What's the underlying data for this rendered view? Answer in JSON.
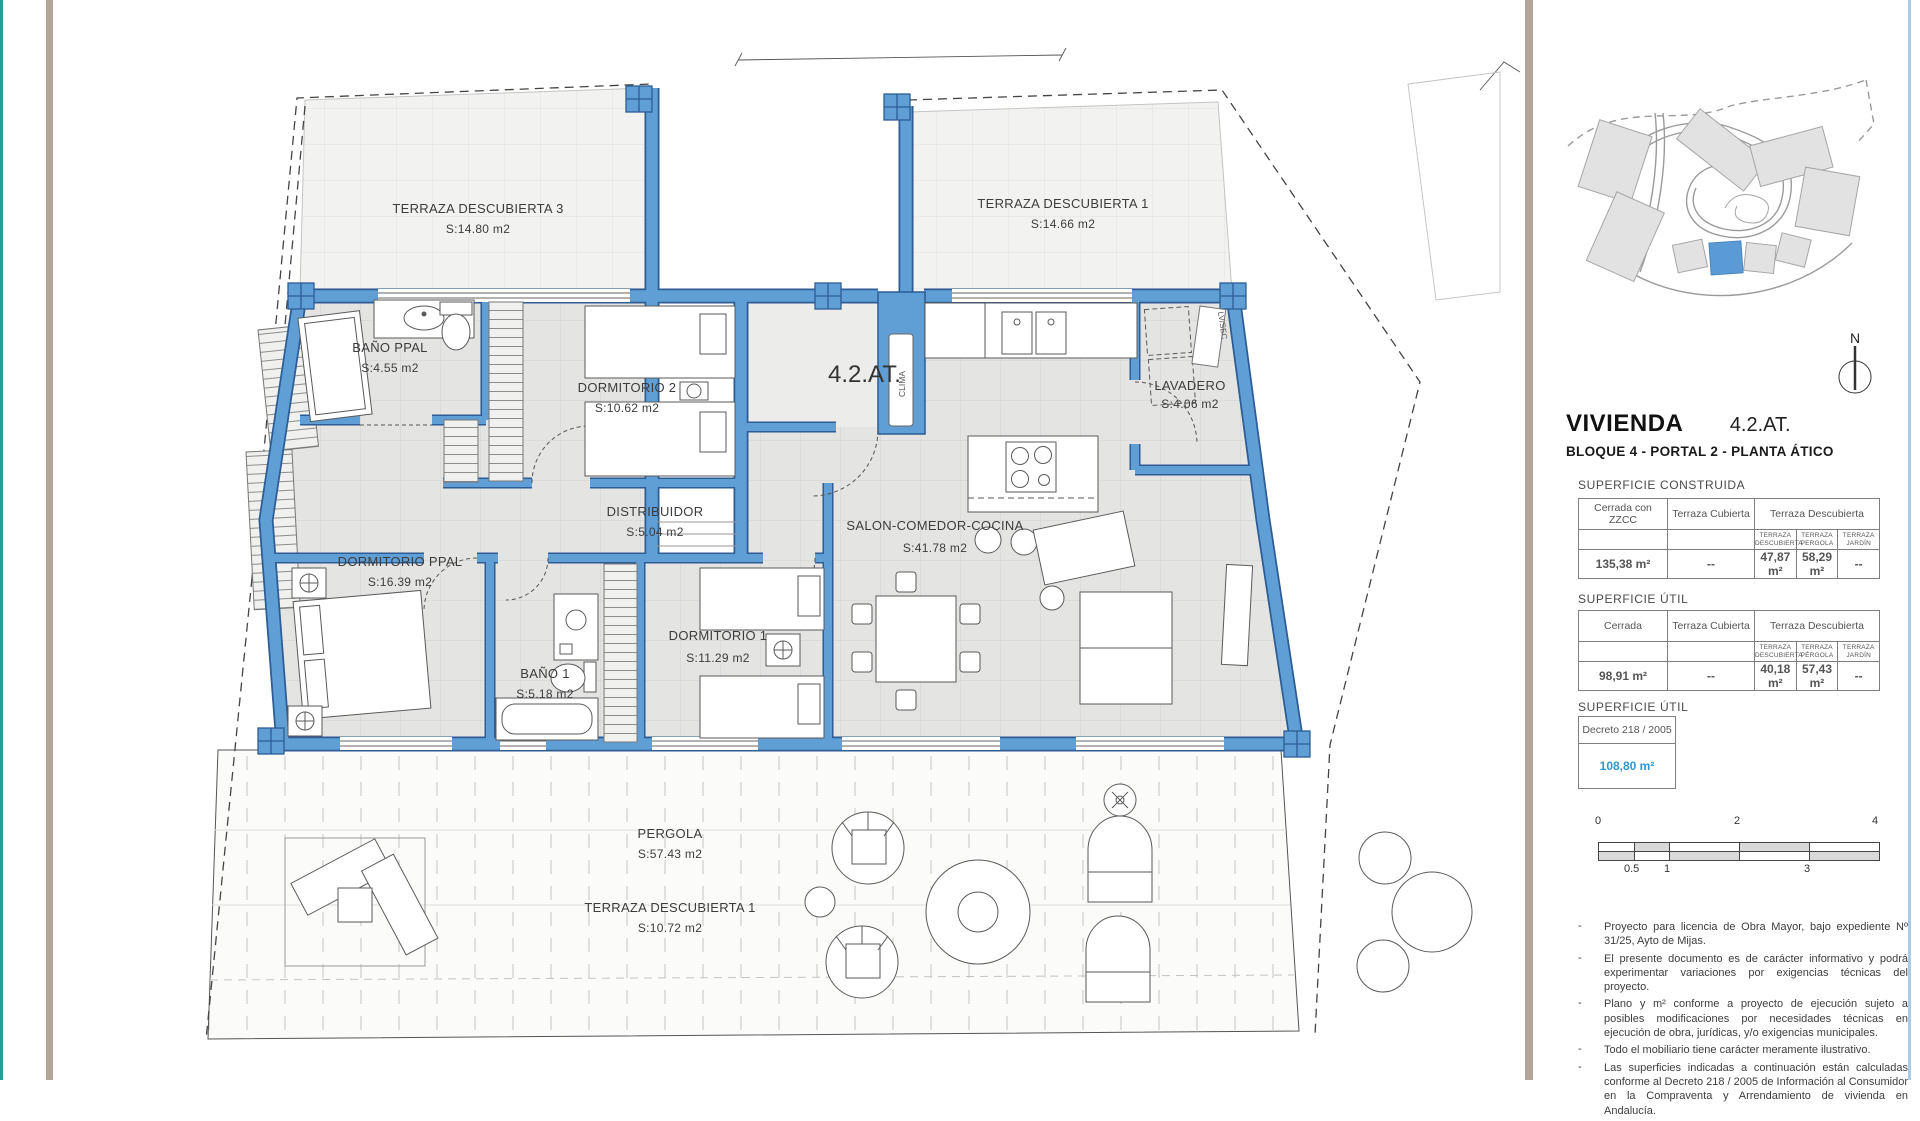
{
  "header": {
    "title": "VIVIENDA",
    "unit": "4.2.AT.",
    "subtitle": "BLOQUE 4 - PORTAL 2 - PLANTA ÁTICO"
  },
  "north_label": "N",
  "plan": {
    "entry_label": "4.2.AT.",
    "clima": "CLIMA",
    "lvsec": "LV/SEC",
    "rooms": [
      {
        "name": "TERRAZA DESCUBIERTA 3",
        "area": "S:14.80 m2"
      },
      {
        "name": "TERRAZA DESCUBIERTA 1",
        "area": "S:14.66 m2"
      },
      {
        "name": "BAÑO PPAL",
        "area": "S:4.55 m2"
      },
      {
        "name": "DORMITORIO 2",
        "area": "S:10.62 m2"
      },
      {
        "name": "LAVADERO",
        "area": "S:4.06 m2"
      },
      {
        "name": "DISTRIBUIDOR",
        "area": "S:5.04 m2"
      },
      {
        "name": "SALON-COMEDOR-COCINA",
        "area": "S:41.78 m2"
      },
      {
        "name": "DORMITORIO PPAL",
        "area": "S:16.39 m2"
      },
      {
        "name": "BAÑO 1",
        "area": "S:5.18 m2"
      },
      {
        "name": "DORMITORIO 1",
        "area": "S:11.29 m2"
      },
      {
        "name": "PERGOLA",
        "area": "S:57.43 m2"
      },
      {
        "name": "TERRAZA DESCUBIERTA 1",
        "area": "S:10.72 m2"
      }
    ]
  },
  "tables": {
    "construida": {
      "section_label": "SUPERFICIE CONSTRUIDA",
      "col1": "Cerrada con ZZCC",
      "col2": "Terraza Cubierta",
      "col3": "Terraza Descubierta",
      "sub": [
        "TERRAZA DESCUBIERTA",
        "TERRAZA PERGOLA",
        "TERRAZA JARDÍN"
      ],
      "values": [
        "135,38 m²",
        "--",
        "47,87 m²",
        "58,29 m²",
        "--"
      ]
    },
    "util": {
      "section_label": "SUPERFICIE ÚTIL",
      "col1": "Cerrada",
      "col2": "Terraza Cubierta",
      "col3": "Terraza Descubierta",
      "sub": [
        "TERRAZA DESCUBIERTA",
        "TERRAZA PÉRGOLA",
        "TERRAZA JARDÍN"
      ],
      "values": [
        "98,91 m²",
        "--",
        "40,18 m²",
        "57,43 m²",
        "--"
      ]
    },
    "util_decreto": {
      "section_label": "SUPERFICIE ÚTIL",
      "box_header": "Decreto  218 / 2005",
      "value": "108,80 m²"
    }
  },
  "scalebar": {
    "top": [
      "0",
      "2",
      "4"
    ],
    "bottom": [
      "0.5",
      "1",
      "3"
    ]
  },
  "disclaimer": [
    "Proyecto para licencia de Obra Mayor, bajo expediente Nº 31/25, Ayto de Mijas.",
    "El presente documento es de carácter informativo y podrá experimentar variaciones por exigencias técnicas del proyecto.",
    "Plano y m² conforme a proyecto de ejecución sujeto a posibles modificaciones por necesidades técnicas en ejecución de obra, jurídicas, y/o exigencias municipales.",
    "Todo el mobiliario tiene carácter meramente ilustrativo.",
    "Las superficies indicadas a continuación están calculadas conforme al Decreto 218 / 2005  de Información al Consumidor en la Compraventa y Arrendamiento de vivienda en Andalucía."
  ],
  "colors": {
    "wall_blue": "#5f9fd6",
    "wall_outline": "#2c5d94",
    "value_blue": "#2e97d1",
    "divider_tan": "#b4a696",
    "edge_teal": "#2a9d99",
    "edge_blue": "#a9cbe8",
    "map_highlight": "#5b9bd5"
  }
}
